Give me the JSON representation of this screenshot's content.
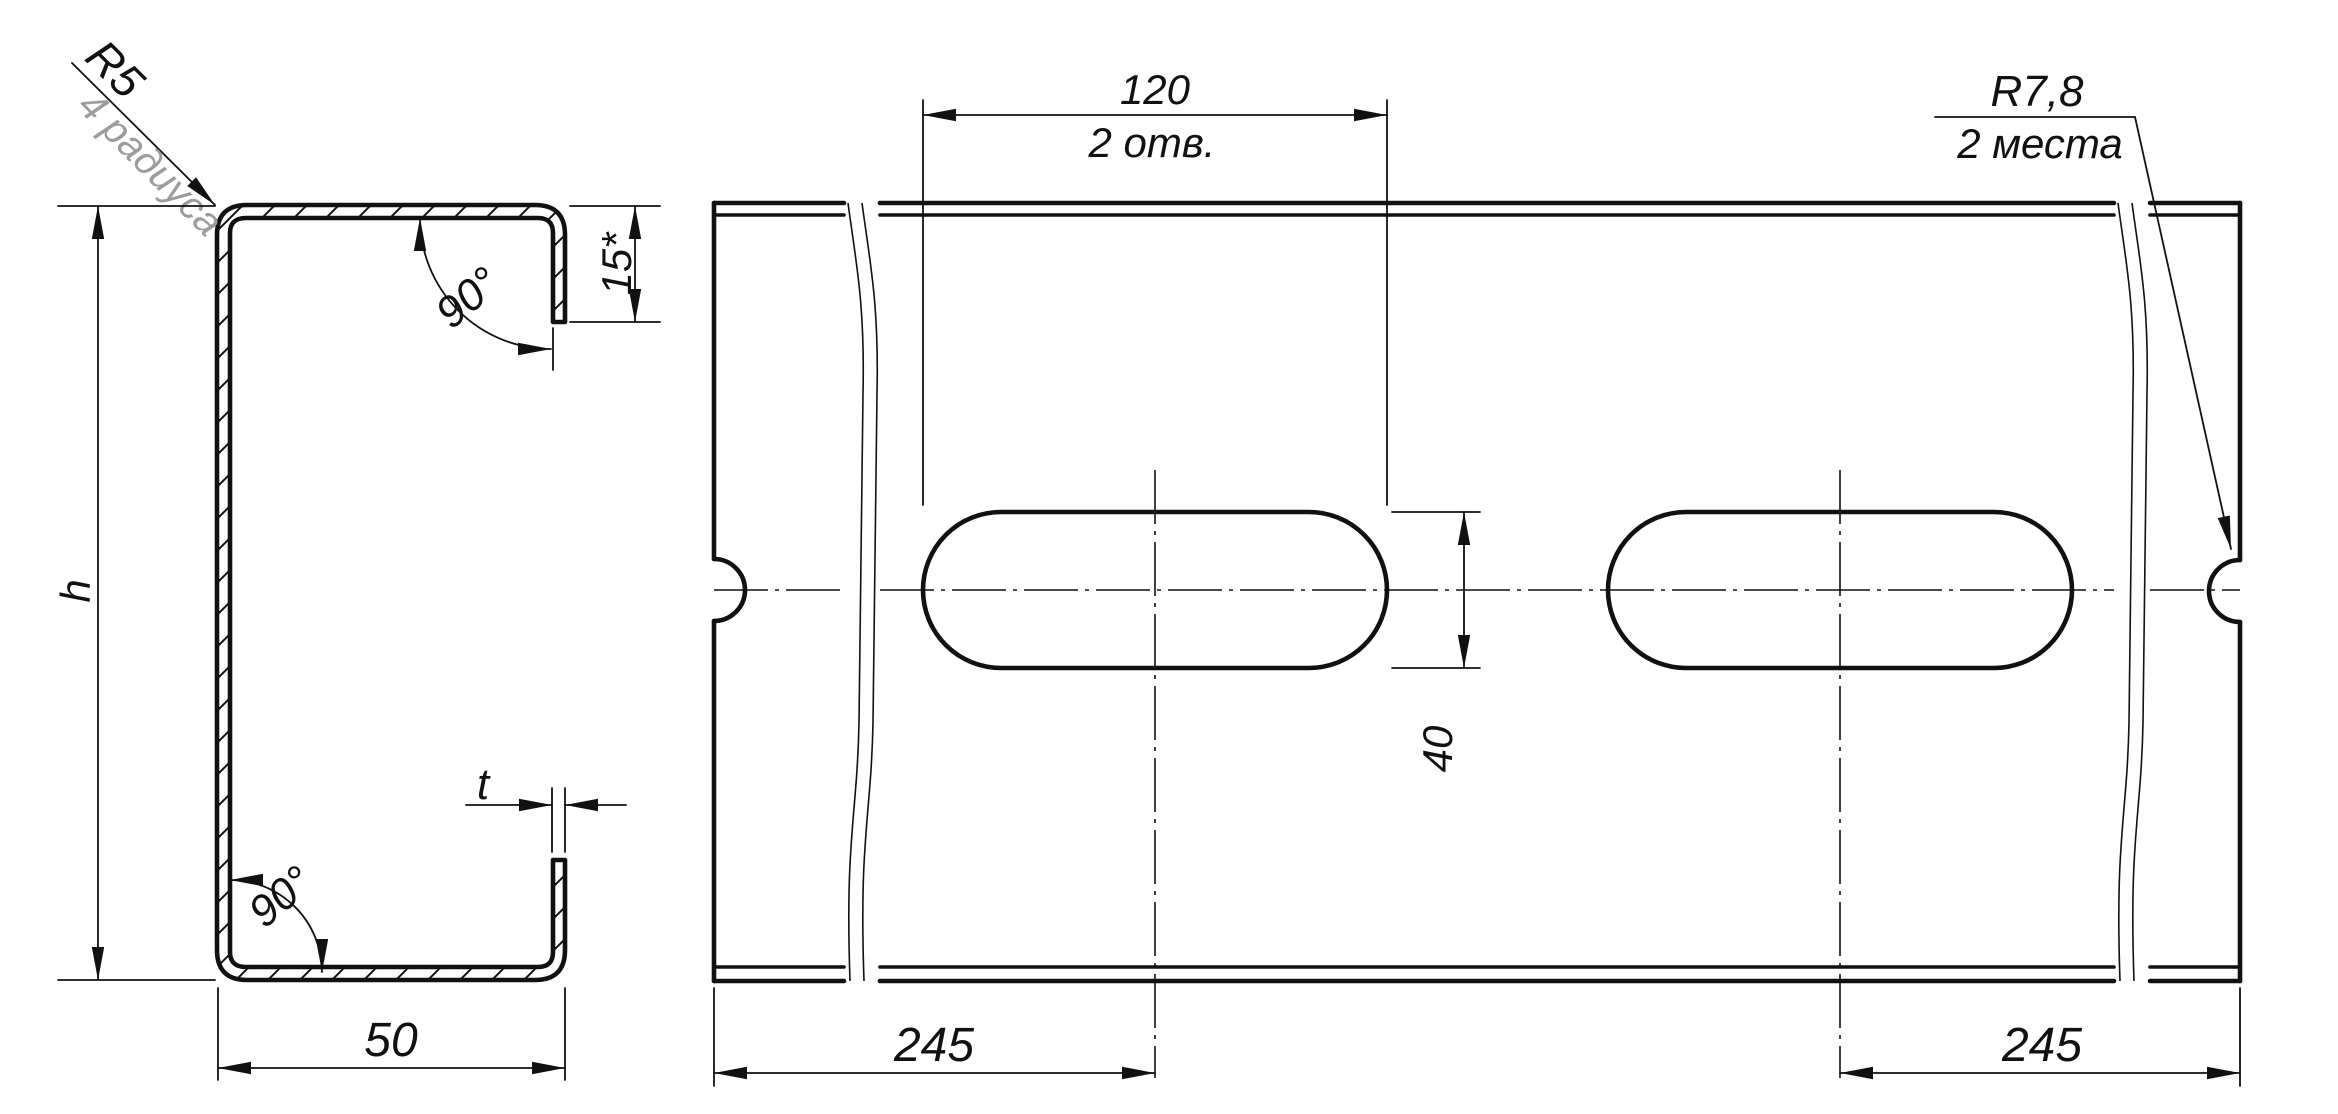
{
  "drawing": {
    "cross_section_view": {
      "radius_callout_value": "R5",
      "radius_callout_note": "4 радиуса",
      "top_angle": "90°",
      "lip_length": "15*",
      "height_label": "h",
      "bottom_angle": "90°",
      "thickness_label": "t",
      "flange_width": "50"
    },
    "face_view": {
      "slot_length": "120",
      "slot_count_note": "2 отв.",
      "notch_radius_value": "R7,8",
      "notch_places_note": "2 места",
      "slot_width": "40",
      "left_slot_offset": "245",
      "right_slot_offset": "245"
    },
    "colors": {
      "line": "#111111",
      "muted_text": "#9c9c9c",
      "background": "#ffffff"
    }
  }
}
